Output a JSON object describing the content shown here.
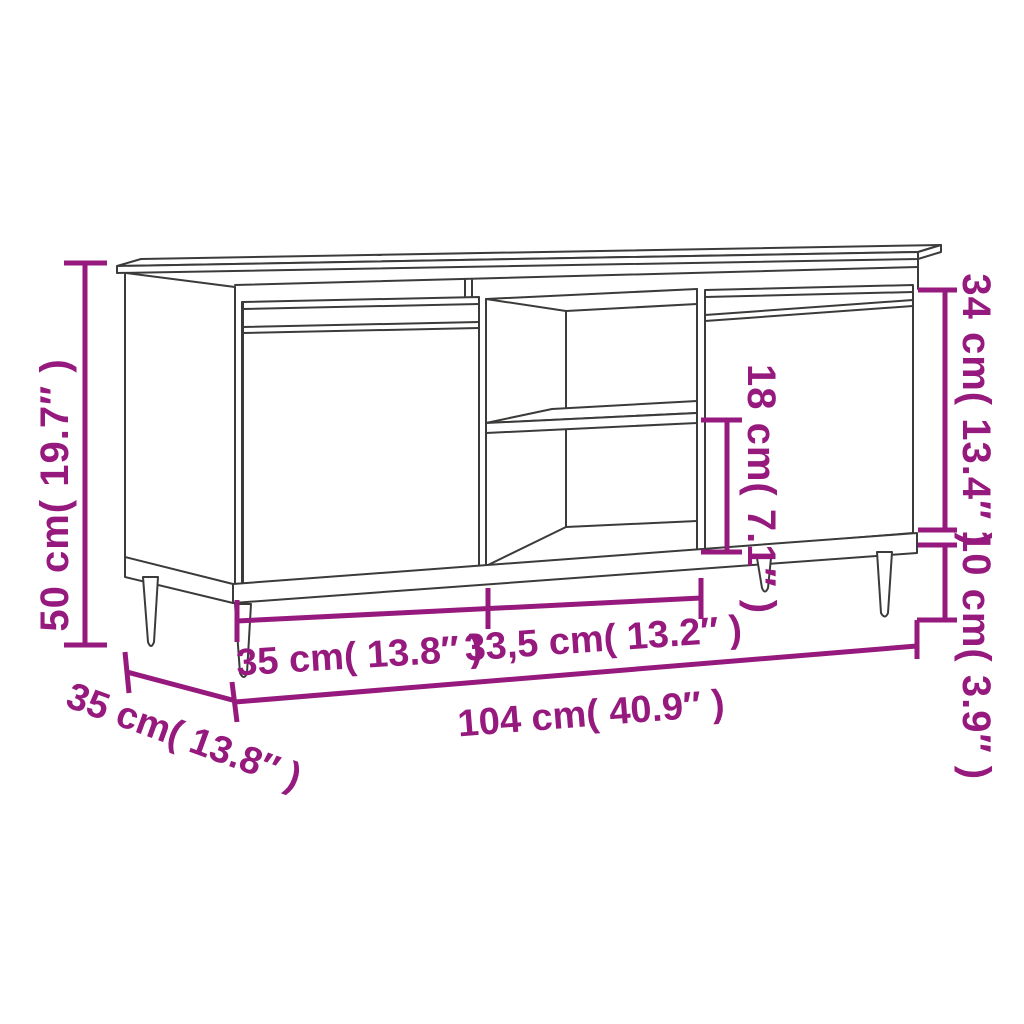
{
  "page": {
    "background": "#FFFFFF",
    "description": "Line-drawing dimension diagram of a TV cabinet with two doors, an open middle shelf compartment and four tapered legs"
  },
  "style": {
    "accent_color": "#96197D",
    "drawing_line_color": "#3B3B3A"
  },
  "dimensions": {
    "overall_height": {
      "label": "50 cm( 19.7″ )",
      "cm": "50",
      "inches": "19.7"
    },
    "door_height": {
      "label": "34 cm( 13.4″ )",
      "cm": "34",
      "inches": "13.4"
    },
    "shelf_opening_height": {
      "label": "18 cm( 7.1″ )",
      "cm": "18",
      "inches": "7.1"
    },
    "leg_height": {
      "label": "10 cm( 3.9″ )",
      "cm": "10",
      "inches": "3.9"
    },
    "left_door_width": {
      "label": "35 cm( 13.8″ )",
      "cm": "35",
      "inches": "13.8"
    },
    "middle_section_width": {
      "label": "33,5 cm( 13.2″ )",
      "cm": "33,5",
      "inches": "13.2"
    },
    "overall_width": {
      "label": "104 cm( 40.9″ )",
      "cm": "104",
      "inches": "40.9"
    },
    "overall_depth": {
      "label": "35 cm( 13.8″ )",
      "cm": "35",
      "inches": "13.8"
    }
  }
}
